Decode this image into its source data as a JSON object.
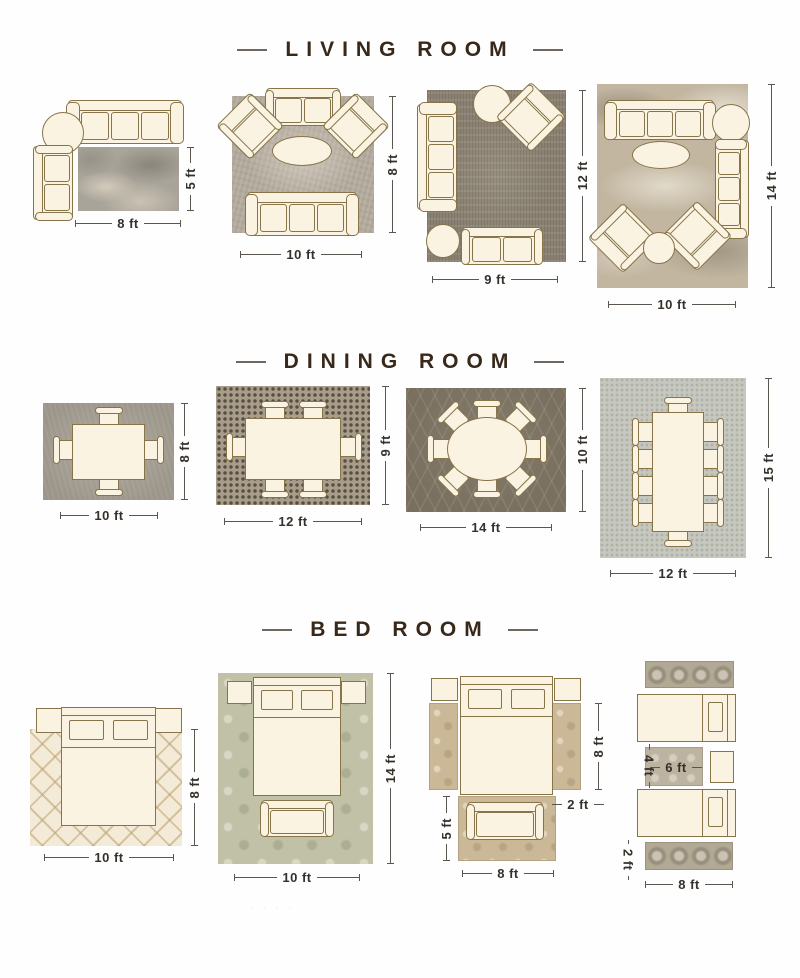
{
  "titles": {
    "living": "LIVING ROOM",
    "dining": "DINING ROOM",
    "bed": "BED ROOM"
  },
  "living": {
    "l1": {
      "w": "8 ft",
      "h": "5 ft"
    },
    "l2": {
      "w": "10 ft",
      "h": "8 ft"
    },
    "l3": {
      "w": "9 ft",
      "h": "12 ft"
    },
    "l4": {
      "w": "10 ft",
      "h": "14 ft"
    }
  },
  "dining": {
    "l1": {
      "w": "10 ft",
      "h": "8 ft"
    },
    "l2": {
      "w": "12 ft",
      "h": "9 ft"
    },
    "l3": {
      "w": "14 ft",
      "h": "10 ft"
    },
    "l4": {
      "w": "12 ft",
      "h": "15 ft"
    }
  },
  "bed": {
    "l1": {
      "w": "10 ft",
      "h": "8 ft"
    },
    "l2": {
      "w": "10 ft",
      "h": "14 ft"
    },
    "l3": {
      "runner_h": "8 ft",
      "runner_w": "2 ft",
      "foot_h": "5 ft",
      "foot_w": "8 ft"
    },
    "l4": {
      "mid_h": "4 ft",
      "mid_w": "6 ft",
      "runner_h": "2 ft",
      "w": "8 ft"
    }
  },
  "colors": {
    "title_text": "#37281a",
    "dimension_text": "#35302a",
    "furniture_fill": "#faf3e2",
    "furniture_outline": "#877449"
  },
  "watermark": "· · · ·"
}
